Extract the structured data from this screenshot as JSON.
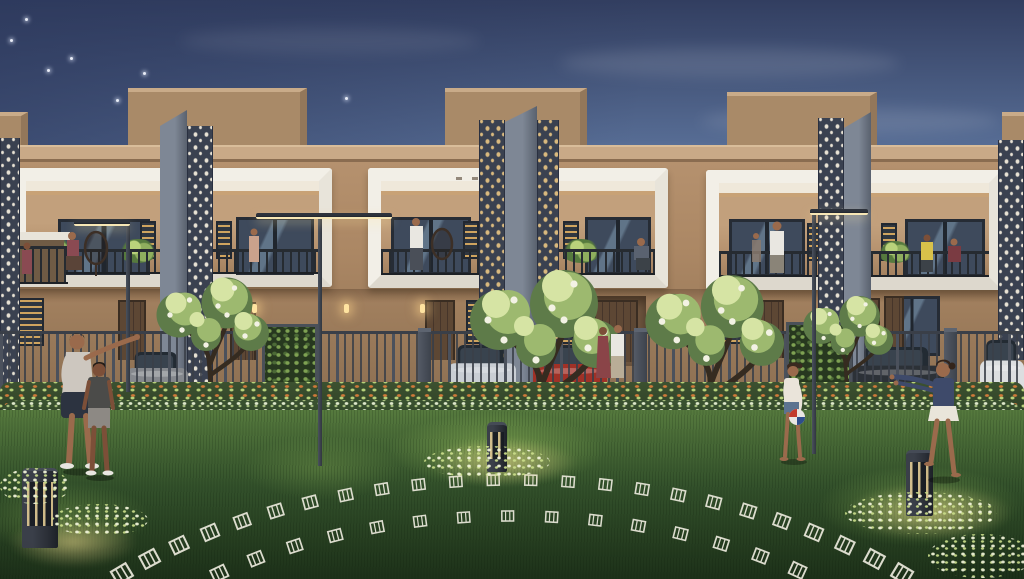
{
  "scene": {
    "alt": "Twilight architectural rendering of a row of duplex villas with white-framed balconies, decorative jali screens, gated parking with cars, flowering hedges, a lawn with ornamental white paving motifs, bollard lights, and families outdoors"
  },
  "palette": {
    "sky_top": "#323e60",
    "sky_mid": "#5f77a0",
    "sky_light": "#a9bccd",
    "sky_horizon": "#ecd2ab",
    "wall": "#b28e6b",
    "wall_light": "#c2a07c",
    "wall_dark": "#8f7355",
    "parapet": "#c9a987",
    "parapet_edge": "#8a6c50",
    "roof_box": "#a98a68",
    "roof_box_top": "#c9ab89",
    "roof_box_side": "#93775a",
    "frame_white": "#f2efe7",
    "frame_shade": "#ddd8cd",
    "ceil": "#efe8da",
    "blade": "#7e8795",
    "blade_dark": "#59616e",
    "jali_bg": "#3a4150",
    "jali_dot": "#e8e2d4",
    "jali_gold": "#d9b97e",
    "glass": "#3e4a5c",
    "glass_hi": "#607488",
    "glass_frame": "#262c35",
    "rail": "#262b31",
    "door": "#5d4734",
    "door_dark": "#46352a",
    "lattice": "#2f3640",
    "lattice_glow": "#cfa45f",
    "fence": "#3a3f48",
    "fence_post": "#4b515c",
    "road": "#6e675b",
    "road_dark": "#524c44",
    "flower_orange": "#d07a3a",
    "leaf_bright": "#b9d27b",
    "hedge2_dot": "#dfe8cb",
    "lawn_light": "#567a3e",
    "lawn_mid": "#33512b",
    "lawn_dark": "#1d3119",
    "motif": "#eceadd",
    "glow": "#ffe3a0",
    "bollard": "#2b2f37",
    "trunk": "#352b20",
    "leaf_light": "#d6e4a4",
    "leaf_mid": "#9db96f",
    "leaf_dark": "#5e7b49",
    "flower_white": "#f3f2e4",
    "skin": "#9a6a4c",
    "skin_dark": "#7c4f38",
    "man_shirt": "#cdc7bf",
    "man_shorts": "#2c3340",
    "boy_shirt": "#4b4b49",
    "boy_shorts": "#8d8984",
    "g1_top": "#eae4da",
    "g1_shorts": "#5c7390",
    "ball_red": "#c23b2e",
    "ball_blue": "#2e4e8c",
    "g2_top": "#3e4a6a",
    "g2_skirt": "#e9e5da",
    "dress": "#8a4448",
    "white_shirt": "#e9e7e1",
    "car_silver": "#c9ced4",
    "car_red": "#a03127",
    "car_dark": "#2c3137",
    "car_white": "#dcdee0",
    "car_gray": "#85888d"
  },
  "sky": {
    "stars": [
      [
        25,
        18
      ],
      [
        70,
        57
      ],
      [
        47,
        69
      ],
      [
        143,
        72
      ],
      [
        116,
        99
      ],
      [
        10,
        39
      ],
      [
        345,
        97
      ]
    ],
    "clouds": [
      {
        "x": 180,
        "y": 28,
        "w": 300,
        "h": 26,
        "o": 0.07
      },
      {
        "x": 560,
        "y": 48,
        "w": 340,
        "h": 30,
        "o": 0.1
      },
      {
        "x": 700,
        "y": 108,
        "w": 300,
        "h": 26,
        "o": 0.1
      },
      {
        "x": 420,
        "y": 150,
        "w": 360,
        "h": 24,
        "o": 0.08
      }
    ]
  },
  "cars": [
    {
      "x": 126,
      "y": 352,
      "w": 62,
      "h": 42,
      "c": "car_gray"
    },
    {
      "x": 448,
      "y": 345,
      "w": 68,
      "h": 48,
      "c": "car_silver"
    },
    {
      "x": 533,
      "y": 345,
      "w": 74,
      "h": 50,
      "c": "car_red"
    },
    {
      "x": 851,
      "y": 347,
      "w": 94,
      "h": 49,
      "c": "car_dark"
    },
    {
      "x": 980,
      "y": 340,
      "w": 44,
      "h": 54,
      "c": "car_white"
    }
  ],
  "trees": [
    {
      "x": 140,
      "y": 270,
      "s": 1.5
    },
    {
      "x": 448,
      "y": 260,
      "s": 2.0
    },
    {
      "x": 625,
      "y": 266,
      "s": 1.85
    },
    {
      "x": 790,
      "y": 290,
      "s": 1.2
    }
  ],
  "lamps": [
    {
      "px": 126,
      "py": 224,
      "ph": 168,
      "hx": 74,
      "hy": 220,
      "hw": 56
    },
    {
      "px": 318,
      "py": 218,
      "ph": 248,
      "hx": 256,
      "hy": 213,
      "hw": 136
    },
    {
      "px": 812,
      "py": 214,
      "ph": 240,
      "hx": 810,
      "hy": 209,
      "hw": 58
    }
  ],
  "bollards": [
    {
      "x": 22,
      "y": 468,
      "w": 36,
      "h": 80
    },
    {
      "x": 487,
      "y": 422,
      "w": 20,
      "h": 50
    },
    {
      "x": 906,
      "y": 450,
      "w": 27,
      "h": 66
    }
  ],
  "glows": [
    {
      "x": 8,
      "y": 516,
      "w": 130,
      "h": 52
    },
    {
      "x": 428,
      "y": 438,
      "w": 150,
      "h": 48
    },
    {
      "x": 846,
      "y": 484,
      "w": 166,
      "h": 56
    }
  ],
  "litplants": [
    {
      "x": 424,
      "y": 446,
      "w": 126,
      "h": 32
    },
    {
      "x": 845,
      "y": 492,
      "w": 152,
      "h": 42
    },
    {
      "x": 52,
      "y": 504,
      "w": 96,
      "h": 32
    },
    {
      "x": 928,
      "y": 534,
      "w": 106,
      "h": 44
    },
    {
      "x": 0,
      "y": 468,
      "w": 70,
      "h": 36
    }
  ],
  "motif_arcs": [
    {
      "cx": 512,
      "cy": 812,
      "rx": 560,
      "ry": 332,
      "from": 42,
      "to": 138,
      "count": 26,
      "size": 1.0
    },
    {
      "cx": 512,
      "cy": 816,
      "rx": 498,
      "ry": 300,
      "from": 55,
      "to": 126,
      "count": 15,
      "size": 0.85
    }
  ]
}
